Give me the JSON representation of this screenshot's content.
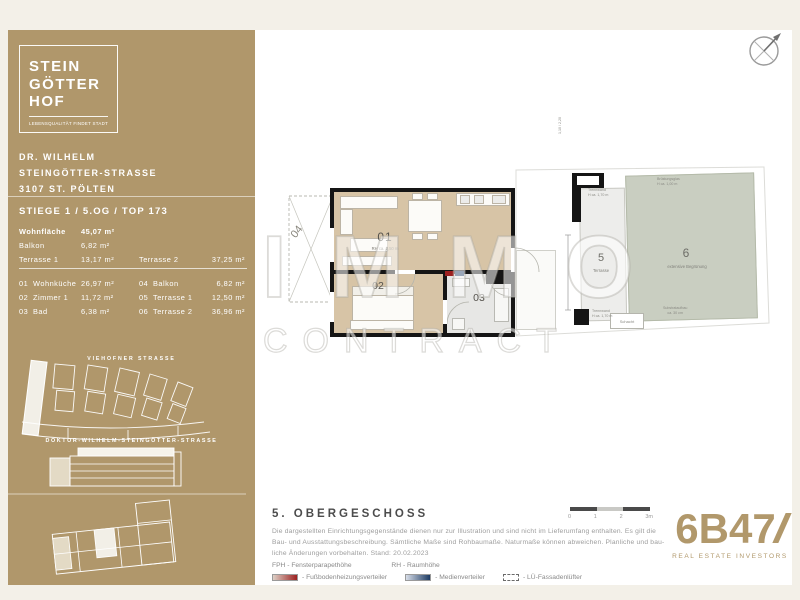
{
  "window": {
    "bg_color": "#f3f0e8",
    "accent_gold": "#b0976b"
  },
  "sidebar": {
    "logo": {
      "line1": "STEIN",
      "line2": "GÖTTER",
      "line3": "HOF",
      "tagline": "LEBENSQUALITÄT FINDET STADT"
    },
    "address": {
      "line1": "DR. WILHELM",
      "line2": "STEINGÖTTER-STRASSE",
      "line3": "3107 ST. PÖLTEN"
    },
    "unit_title": "STIEGE 1 / 5.OG / TOP 173",
    "summary": {
      "rows": [
        {
          "l": "Wohnfläche",
          "v": "45,07 m²"
        },
        {
          "l": "Balkon",
          "v": "6,82 m²"
        },
        {
          "l": "Terrasse 1",
          "v": "13,17 m²",
          "l2": "Terrasse 2",
          "v2": "37,25 m²"
        }
      ]
    },
    "rooms": [
      {
        "n": "01",
        "l": "Wohnküche",
        "v": "26,97 m²",
        "n2": "04",
        "l2": "Balkon",
        "v2": "6,82 m²"
      },
      {
        "n": "02",
        "l": "Zimmer 1",
        "v": "11,72 m²",
        "n2": "05",
        "l2": "Terrasse 1",
        "v2": "12,50 m²"
      },
      {
        "n": "03",
        "l": "Bad",
        "v": "6,38 m²",
        "n2": "06",
        "l2": "Terrasse 2",
        "v2": "36,96 m²"
      }
    ],
    "map": {
      "street_top": "VIEHOFNER STRASSE",
      "street_bottom": "DOKTOR-WILHELM-STEINGÖTTER-STRASSE"
    }
  },
  "plan": {
    "labels": {
      "r1": "01",
      "r1_sub": "RH ca. 2,50 m",
      "r2": "02",
      "r3": "03",
      "r4": "04",
      "t5": "5",
      "t5_sub": "Terrasse",
      "t6": "6",
      "t6_sub": "extensive Begrünung"
    },
    "annotations": {
      "trenn1_l1": "Trennwand",
      "trenn1_l2": "H ca. 1,70 m",
      "trenn2_l1": "Trennwand",
      "trenn2_l2": "H ca. 1,70 m",
      "bruestung_l1": "Brüstungsglas",
      "bruestung_l2": "H ca. 1,00 m",
      "substrat_l1": "Substrataufbau",
      "substrat_l2": "ca. 30 cm",
      "schacht": "Schacht",
      "dim": "1,10 / 2,20"
    },
    "colors": {
      "room_tan": "#d7c4a6",
      "room_grey": "#e7e7e5",
      "terrace": "#ededeb",
      "greenery": "#c9cec1",
      "wall": "#151515"
    }
  },
  "watermark": {
    "line1": "IMMO",
    "line2": "CONTRACT"
  },
  "footer": {
    "title": "5. OBERGESCHOSS",
    "disclaimer_l1": "Die dargestellten Einrichtungsgegenstände dienen nur zur Illustration und sind nicht im Lieferumfang enthalten. Es gilt die",
    "disclaimer_l2": "Bau- und Ausstattungsbeschreibung. Sämtliche Maße sind Rohbaumaße. Naturmaße können abweichen. Planliche und bau-",
    "disclaimer_l3": "liche Änderungen vorbehalten. Stand: 20.02.2023",
    "abbr_fph": "FPH - Fensterparapethöhe",
    "abbr_rh": "RH - Raumhöhe",
    "legend_red": "- Fußbodenheizungsverteiler",
    "legend_blue": "- Medienverteiler",
    "legend_dashed": "- LÜ-Fassadenlüfter",
    "scale": {
      "t0": "0",
      "t1": "1",
      "t2": "2",
      "t3": "3m"
    },
    "legend_colors": {
      "red": "#9c2020",
      "blue": "#1d3b63"
    }
  },
  "brand": {
    "name": "6B47",
    "sub": "REAL ESTATE INVESTORS",
    "color": "#b1986b"
  }
}
